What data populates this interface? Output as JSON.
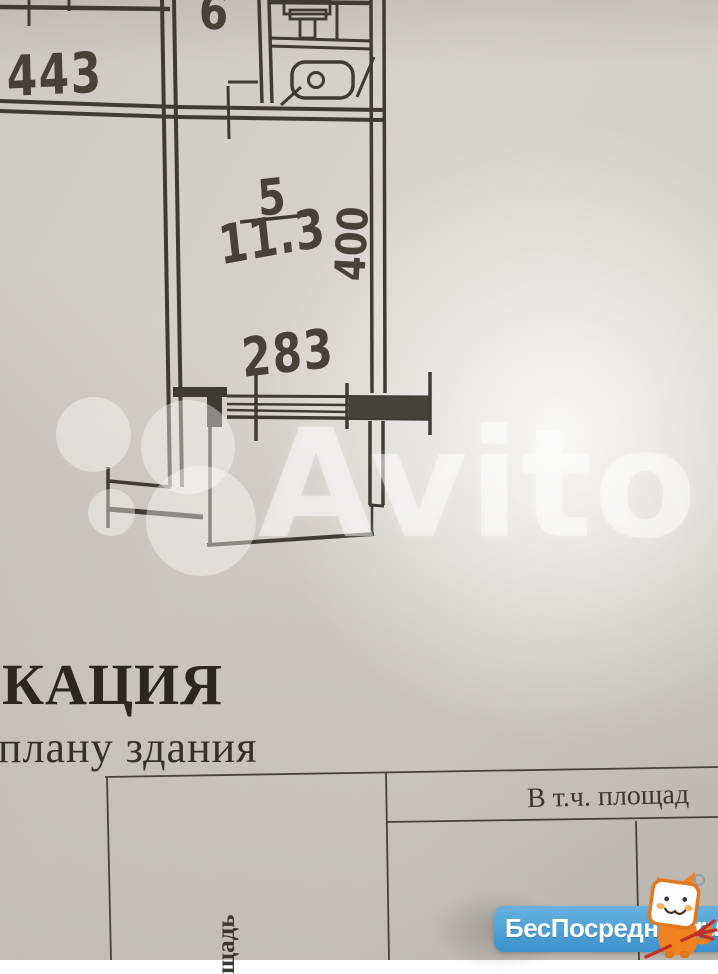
{
  "floor_plan": {
    "labels": {
      "room_top_left": "443",
      "corridor": "6",
      "room_number": "5",
      "room_area": "11.3",
      "height_dim": "400",
      "window_dim": "283"
    },
    "line_color": "#3e3a34"
  },
  "document": {
    "title_fragment": "КАЦИЯ",
    "subtitle_fragment": "плану здания",
    "table": {
      "header_right": "В т.ч. площад",
      "header_vertical": "щадь"
    },
    "text_color": "#2f2c26"
  },
  "watermark": {
    "brand": "Avito",
    "color": "#ffffff"
  },
  "badge": {
    "brand": "БесПосредника",
    "tld": ".ru",
    "bg_color": "#4599d3",
    "accent_orange": "#f0831f",
    "accent_red": "#c2302a",
    "mascot": "orange-cat-tv-mascot"
  }
}
